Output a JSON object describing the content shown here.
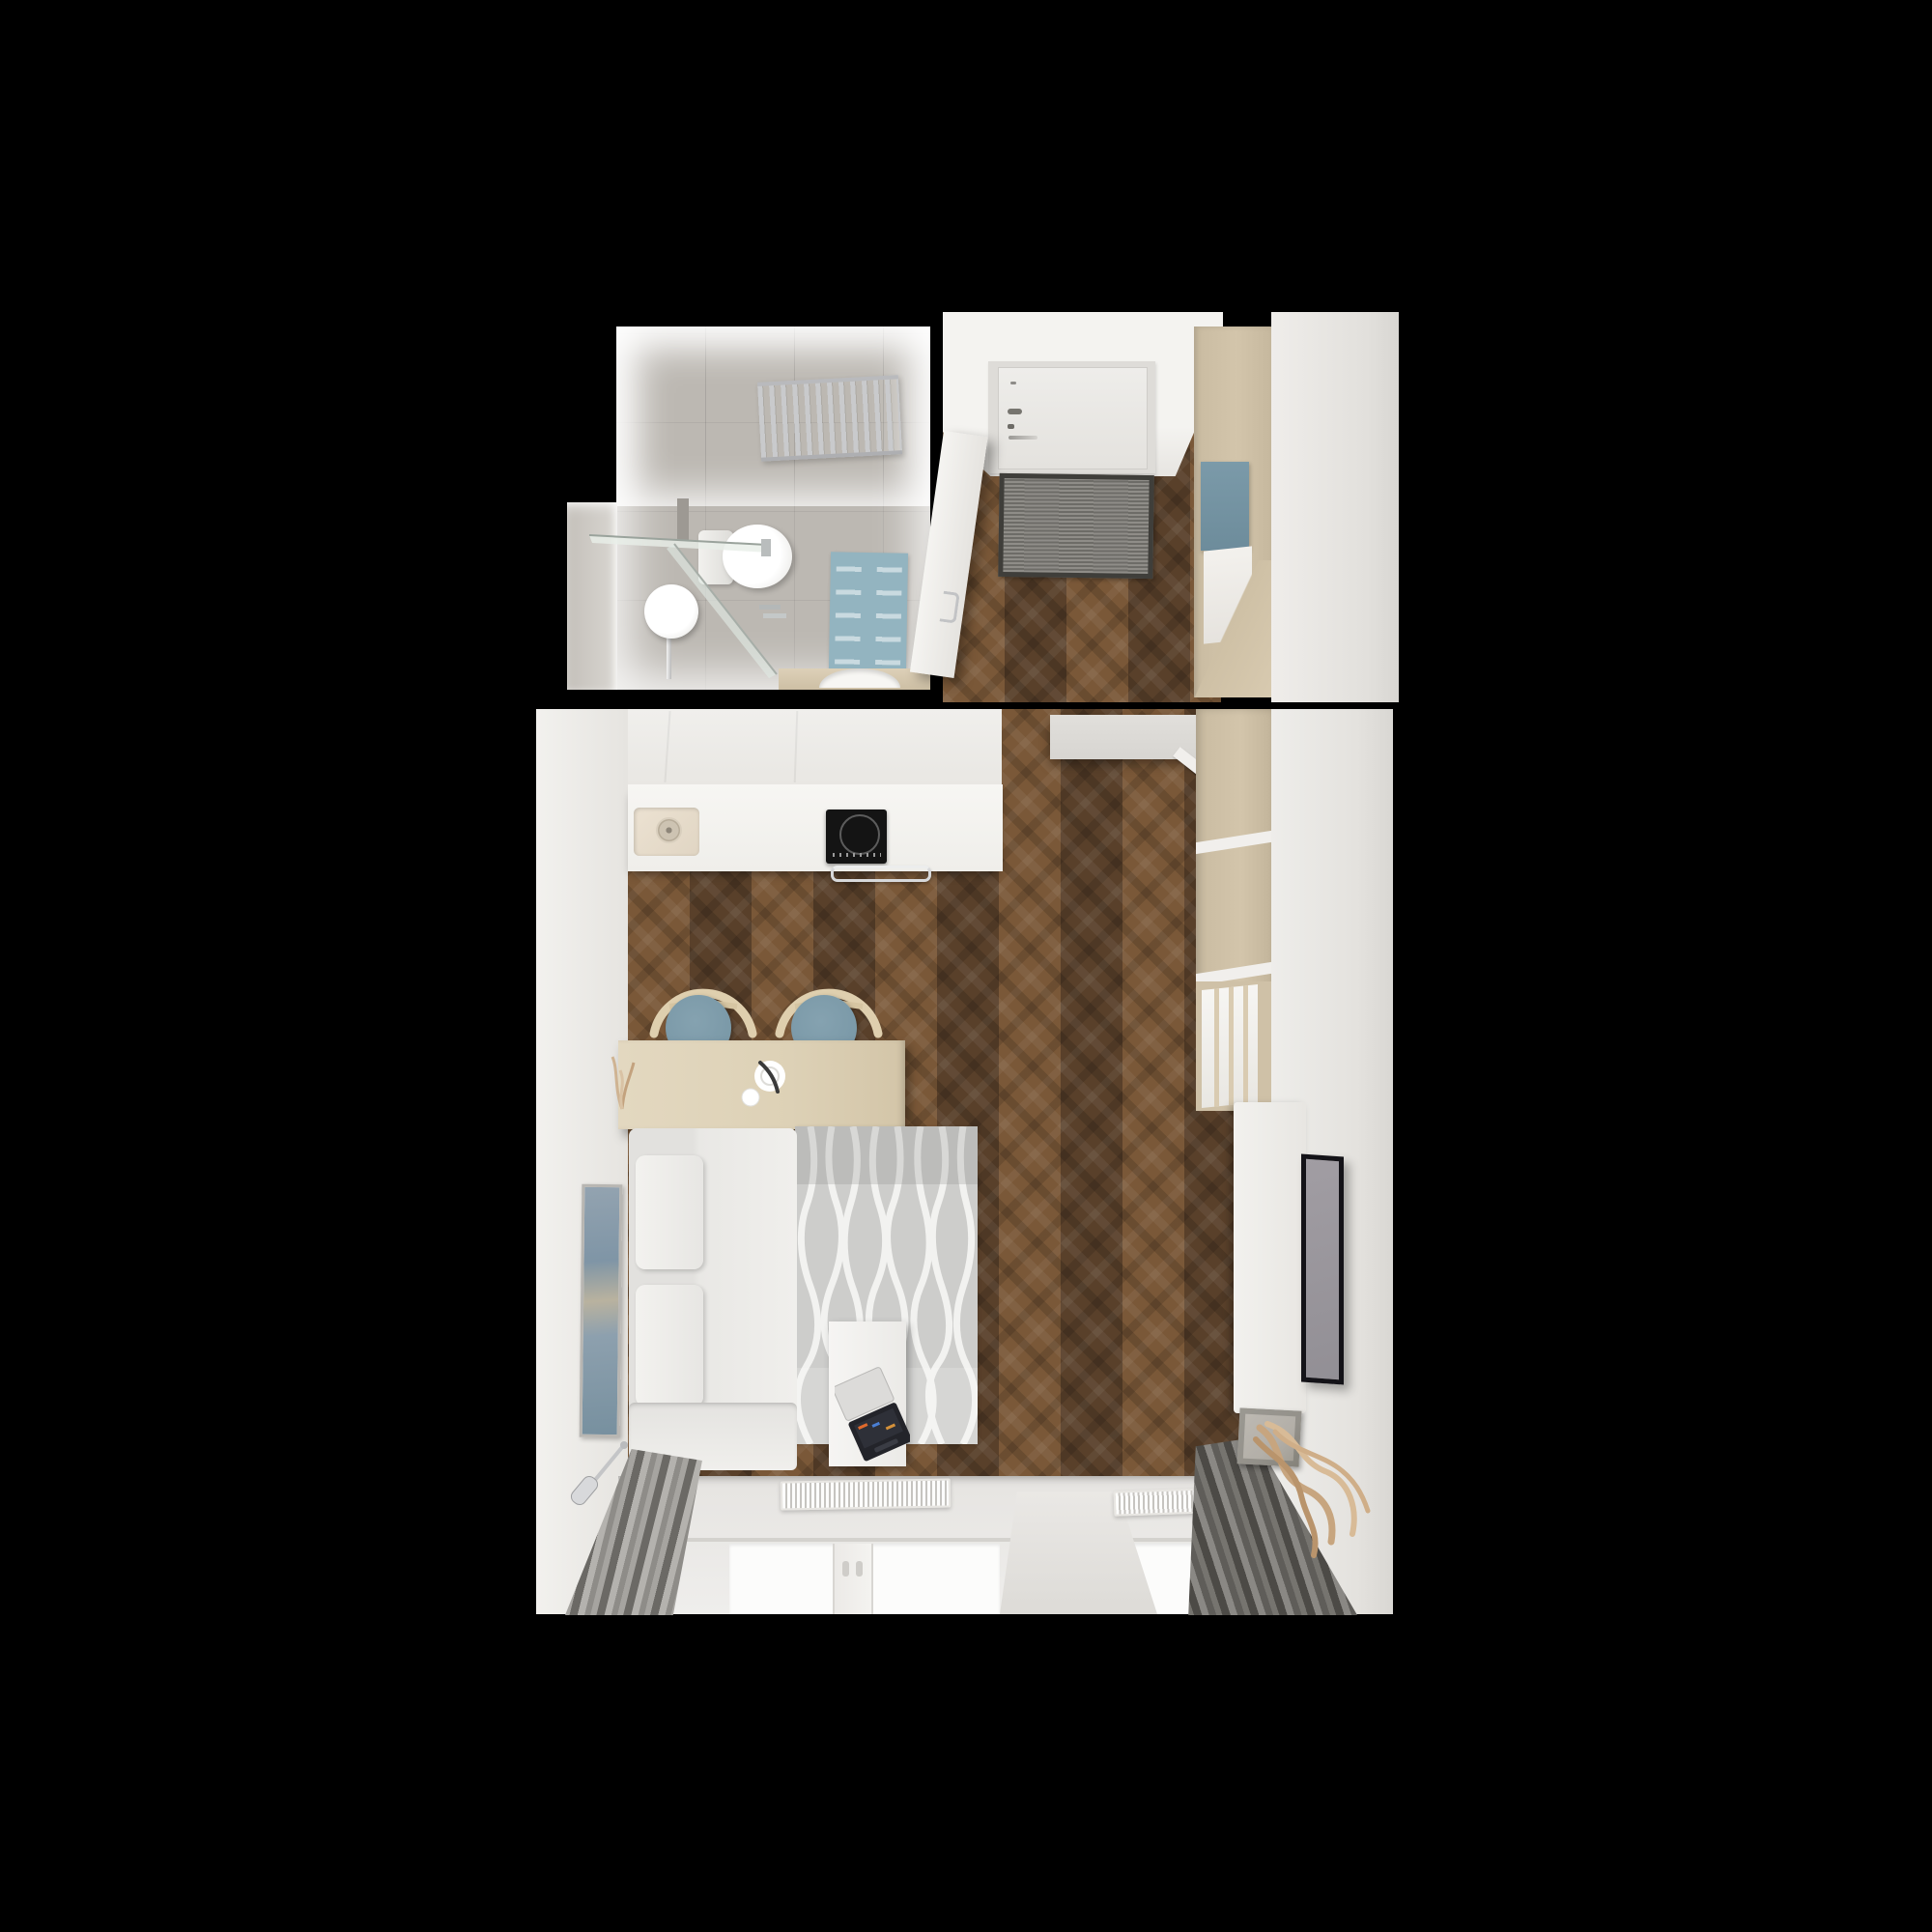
{
  "scene": {
    "description": "Top-down 3D architectural render of a small studio apartment floor plan on a black background",
    "image_type": "floor-plan-render",
    "visible_text": "none"
  },
  "palette": {
    "bg": "#000000",
    "wood_mid": "#6b4c30",
    "wood_dark": "#59402a",
    "wood_light": "#7a5838",
    "tile_wall": "#d7d4cf",
    "tile_floor": "#bcb8b2",
    "white_wall": "#eceae7",
    "white_bright": "#f6f5f2",
    "beige_closet": "#d3c5ab",
    "blue_seat": "#7695a4",
    "blue_mat": "#93b4c0",
    "blue_cushion": "#7b9aa9",
    "sofa": "#e9e8e5",
    "rug_base": "#cdcdcb",
    "curtain_light": "#b4b2ae",
    "curtain_dark": "#6b6965",
    "mat_gray": "#82807b",
    "mat_border": "#3f3e3a",
    "glass_white": "#fcfcfb",
    "tv_frame": "#141318",
    "tv_screen": "#928f95",
    "wood_table": "#ddd1b6",
    "chrome": "#c9cacc",
    "driftwood": "#c7a57f",
    "art_blue": "#7f95a6",
    "art_tan": "#b9b29f",
    "planter": "#b3afa8",
    "cooktop": "#141414",
    "sink_beige": "#ece2d2"
  },
  "rooms": [
    {
      "name": "bathroom",
      "position": "top-left",
      "objects": [
        "gray floor tiles",
        "chrome towel radiator",
        "toilet",
        "glass shower enclosure",
        "round pedestal basin",
        "blue bath mat",
        "wood vanity with vessel sink",
        "wall niche"
      ]
    },
    {
      "name": "hallway",
      "position": "top-right",
      "objects": [
        "white entry door with lock and handle",
        "gray doormat",
        "open interior door",
        "herringbone wood floor",
        "tall beige wardrobe",
        "blue bench cushion",
        "white bench front"
      ]
    },
    {
      "name": "living-room-with-kitchen",
      "position": "bottom",
      "objects": [
        "white kitchen counter",
        "beige sink with drain",
        "black induction cooktop",
        "chrome oven handle",
        "light wood dining table",
        "two blue bow-back chairs",
        "coffee cup and plate",
        "white corner sofa with cushions",
        "gray wavy rug",
        "white side table",
        "open laptop",
        "wall-mounted tv",
        "white tv cabinet",
        "beige wardrobe with open shelves",
        "abstract wall art",
        "chrome wall sconce",
        "two windows with white radiators",
        "gray curtains",
        "concrete planter with driftwood",
        "herringbone wood floor"
      ]
    }
  ]
}
